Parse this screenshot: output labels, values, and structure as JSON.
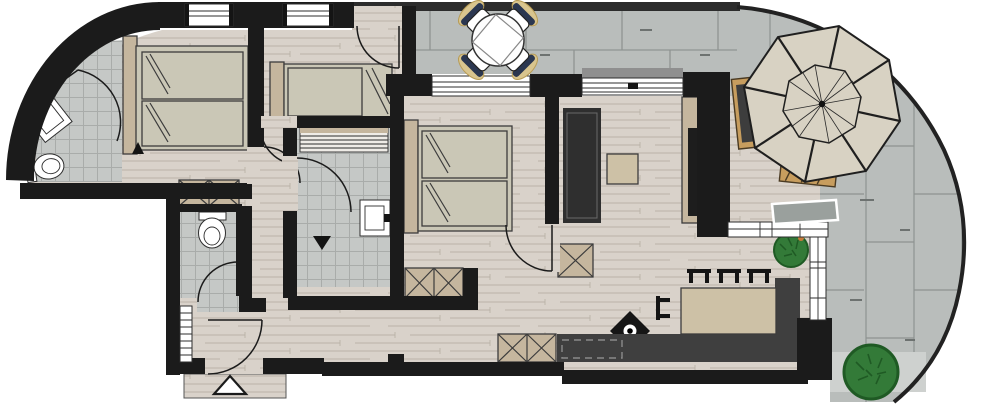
{
  "title": "apartment-floor-plan",
  "palette": {
    "wall": "#1b1b1b",
    "wood": "#d9d2ca",
    "wood_line": "#bab2a8",
    "tile": "#c5c8c6",
    "tile_line": "#a9acaa",
    "terrace": "#b9bdbb",
    "terrace_line": "#8e9391",
    "terrace_edge": "#222222",
    "mattress": "#cac7b6",
    "furniture_tan": "#c5b69e",
    "table_tan": "#cdc1a6",
    "counter": "#3f3f3f",
    "sofa": "#2f2f2f",
    "tv": "#1d1d1d",
    "plant": "#337a38",
    "plant_dark": "#1f5a24",
    "parasol": "#d8d2c3",
    "lounger_tan": "#c79d5e",
    "chair_navy": "#2b3750",
    "cushion": "#d9c58e",
    "sill_gray": "#8f8f8f",
    "bench_gray": "#9aa09d",
    "walkway": "#ced1cf",
    "lamp": "#161616"
  },
  "inventory": {
    "items": [
      {
        "name": "double-bed",
        "count": 2
      },
      {
        "name": "single-bed",
        "count": 1
      },
      {
        "name": "wardrobe-closet",
        "count": 4
      },
      {
        "name": "toilet",
        "count": 2
      },
      {
        "name": "washbasin",
        "count": 2
      },
      {
        "name": "shower-bench",
        "count": 1
      },
      {
        "name": "sofa",
        "count": 1
      },
      {
        "name": "coffee-table",
        "count": 1
      },
      {
        "name": "tv-sideboard",
        "count": 1
      },
      {
        "name": "dining-table",
        "count": 1
      },
      {
        "name": "dining-chair",
        "count": 4
      },
      {
        "name": "kitchen-counter",
        "count": 1
      },
      {
        "name": "cooktop",
        "count": 1
      },
      {
        "name": "round-patio-table",
        "count": 1
      },
      {
        "name": "patio-chair",
        "count": 4
      },
      {
        "name": "parasol",
        "count": 1
      },
      {
        "name": "sun-lounger",
        "count": 2
      },
      {
        "name": "outdoor-bench",
        "count": 1
      },
      {
        "name": "potted-plant",
        "count": 1
      },
      {
        "name": "garden-bush",
        "count": 1
      },
      {
        "name": "ceiling-lamp",
        "count": 1
      },
      {
        "name": "radiator",
        "count": 1
      },
      {
        "name": "entrance-arrow",
        "count": 1
      },
      {
        "name": "window",
        "count": 5
      },
      {
        "name": "door-swing",
        "count": 8
      }
    ]
  }
}
